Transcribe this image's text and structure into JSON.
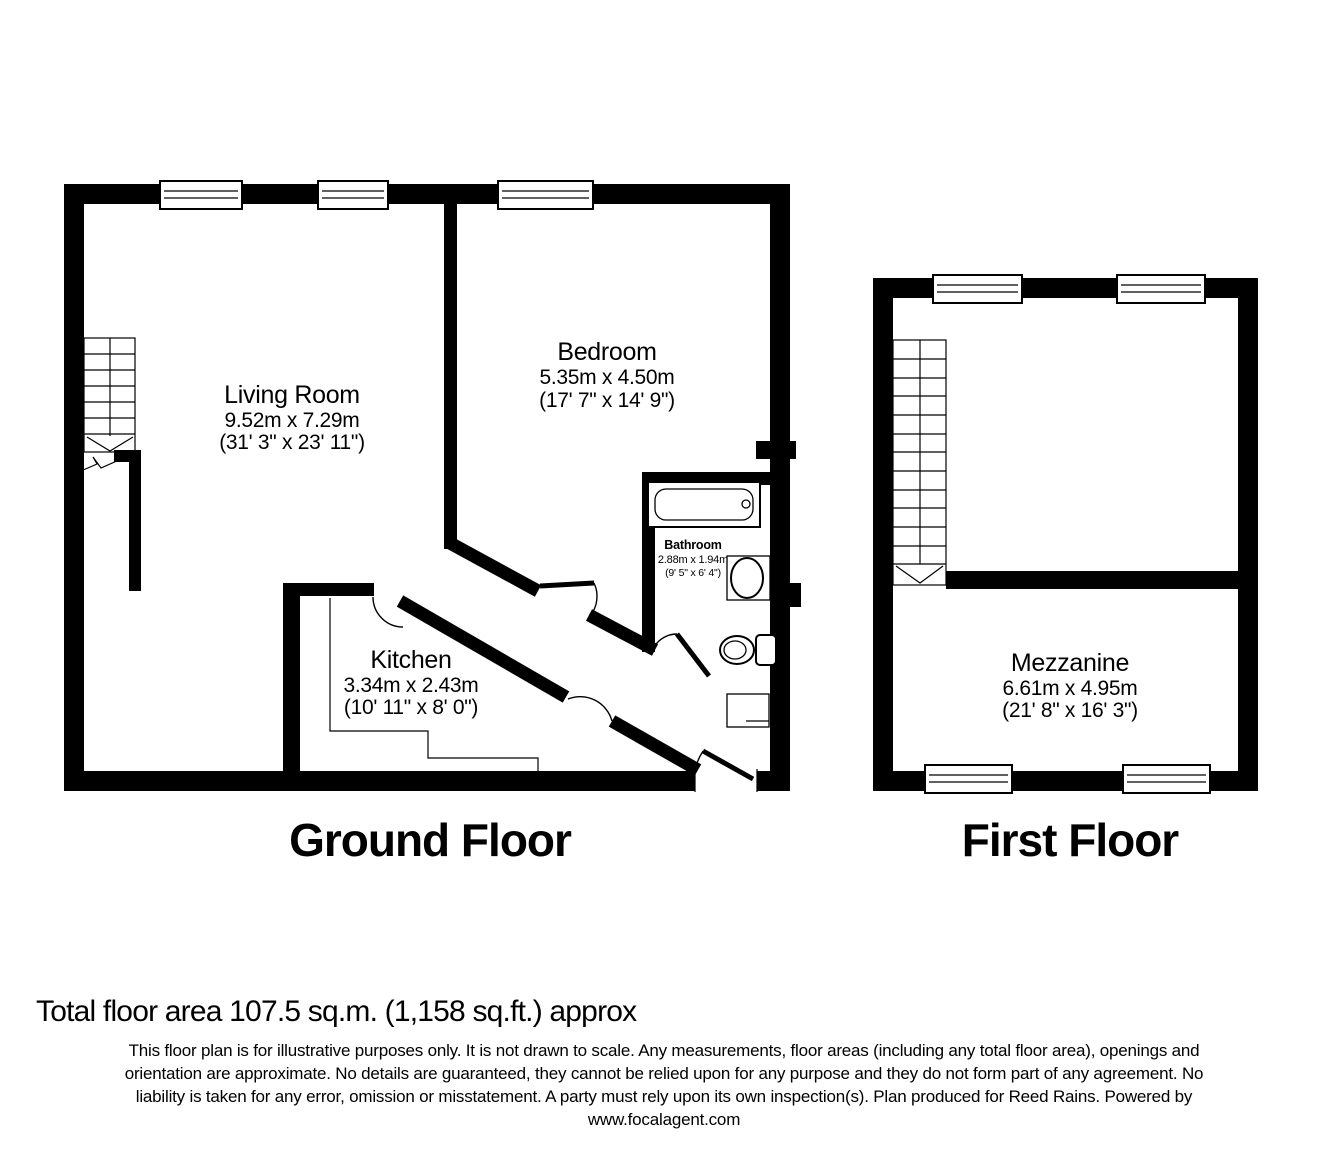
{
  "ground_floor": {
    "title": "Ground Floor",
    "living_room": {
      "name": "Living Room",
      "metric": "9.52m x 7.29m",
      "imperial": "(31' 3\" x 23' 11\")"
    },
    "bedroom": {
      "name": "Bedroom",
      "metric": "5.35m x 4.50m",
      "imperial": "(17' 7\" x 14' 9\")"
    },
    "kitchen": {
      "name": "Kitchen",
      "metric": "3.34m x 2.43m",
      "imperial": "(10' 11\" x 8' 0\")"
    },
    "bathroom": {
      "name": "Bathroom",
      "metric": "2.88m x 1.94m",
      "imperial": "(9' 5\" x 6' 4\")"
    }
  },
  "first_floor": {
    "title": "First Floor",
    "mezzanine": {
      "name": "Mezzanine",
      "metric": "6.61m x 4.95m",
      "imperial": "(21' 8\" x 16' 3\")"
    }
  },
  "footer": {
    "total_area": "Total floor area 107.5 sq.m. (1,158 sq.ft.) approx",
    "disclaimer": [
      "This floor plan is for illustrative purposes only. It is not drawn to scale. Any measurements, floor areas (including any total floor area), openings and",
      "orientation are approximate. No details are guaranteed, they cannot be relied upon for any purpose and they do not form part of any agreement. No",
      "liability is taken for any error, omission or misstatement. A party must rely upon its own inspection(s). Plan produced for Reed Rains. Powered by",
      "www.focalagent.com"
    ]
  },
  "colors": {
    "wall": "#000000",
    "background": "#ffffff",
    "text": "#000000"
  }
}
